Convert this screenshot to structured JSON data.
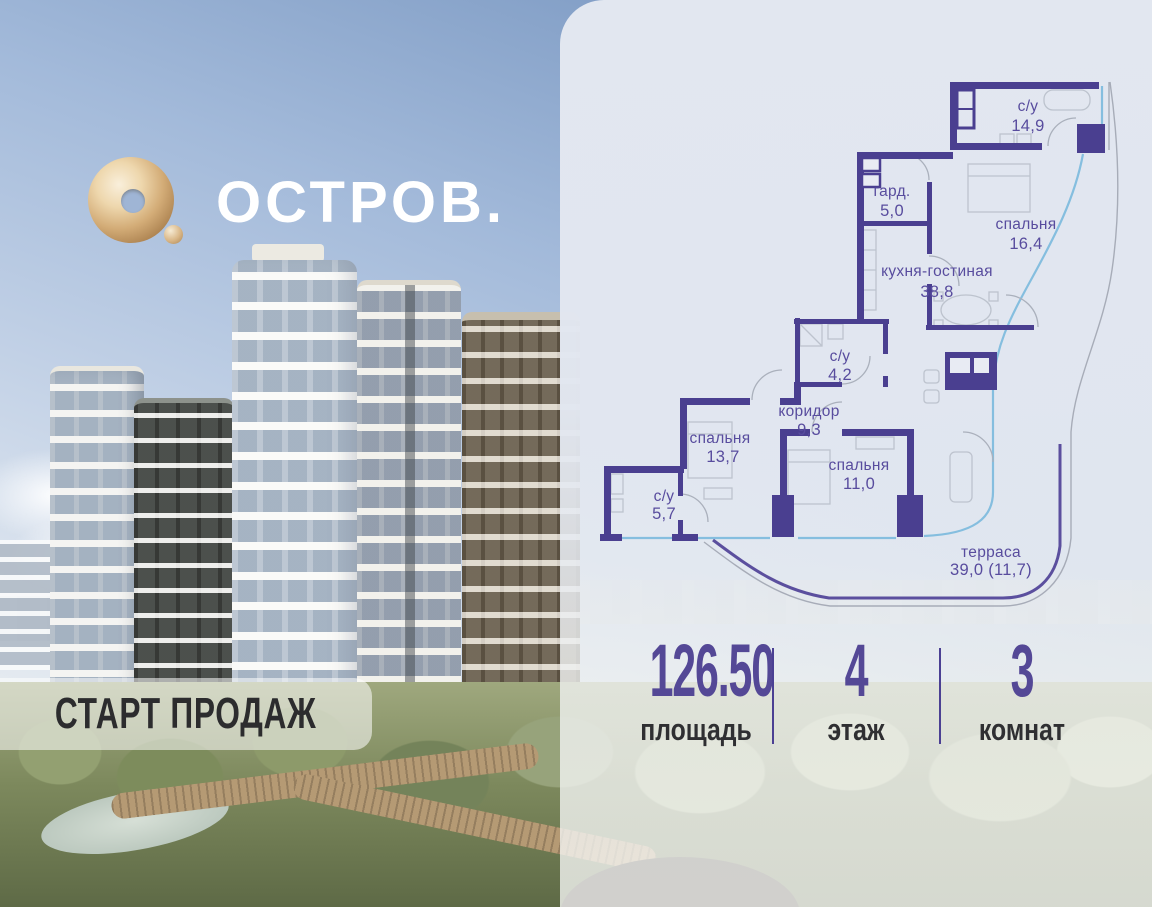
{
  "brand": {
    "logo_text": "ОСТРОВ.",
    "logo_icon": "gold-torus"
  },
  "badge": {
    "label": "СТАРТ ПРОДАЖ"
  },
  "floor_plan": {
    "rooms": [
      {
        "name": "с/у",
        "area": "14,9"
      },
      {
        "name": "гард.",
        "area": "5,0"
      },
      {
        "name": "спальня",
        "area": "16,4"
      },
      {
        "name": "кухня-гостиная",
        "area": "38,8"
      },
      {
        "name": "с/у",
        "area": "4,2"
      },
      {
        "name": "коридор",
        "area": "9,3"
      },
      {
        "name": "спальня",
        "area": "13,7"
      },
      {
        "name": "спальня",
        "area": "11,0"
      },
      {
        "name": "с/у",
        "area": "5,7"
      },
      {
        "name": "терраса",
        "area": "39,0 (11,7)"
      }
    ]
  },
  "stats": {
    "items": [
      {
        "value": "126.50",
        "label": "площадь"
      },
      {
        "value": "4",
        "label": "этаж"
      },
      {
        "value": "3",
        "label": "комнат"
      }
    ]
  },
  "colors": {
    "wall": "#4a3f90",
    "room_label": "#584c9e",
    "accent_number": "#544896",
    "glass_line": "#85bedf",
    "terrace_line": "#5b4f9e",
    "panel_bg": "#e2e7f0",
    "dark_text": "#2f2f32",
    "logo_gold": "#d3ac77"
  }
}
